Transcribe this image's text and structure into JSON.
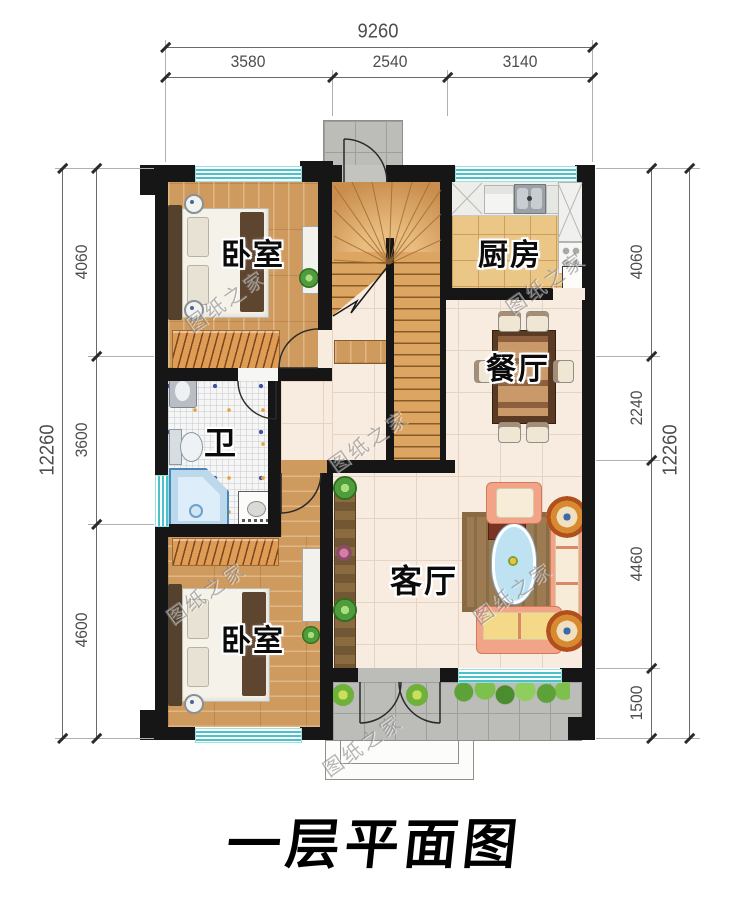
{
  "title": "一层平面图",
  "watermark": {
    "text": "图纸之家"
  },
  "rooms": {
    "bedroom_top": {
      "label": "卧室"
    },
    "kitchen": {
      "label": "厨房"
    },
    "dining": {
      "label": "餐厅"
    },
    "bathroom": {
      "label": "卫"
    },
    "living": {
      "label": "客厅"
    },
    "bedroom_bottom": {
      "label": "卧室"
    }
  },
  "dims": {
    "top": {
      "total": "9260",
      "segments": [
        "3580",
        "2540",
        "3140"
      ]
    },
    "left": {
      "total": "12260",
      "segments": [
        "4060",
        "3600",
        "4600"
      ]
    },
    "right": {
      "total": "12260",
      "segments": [
        "4060",
        "2240",
        "4460",
        "1500"
      ]
    }
  }
}
